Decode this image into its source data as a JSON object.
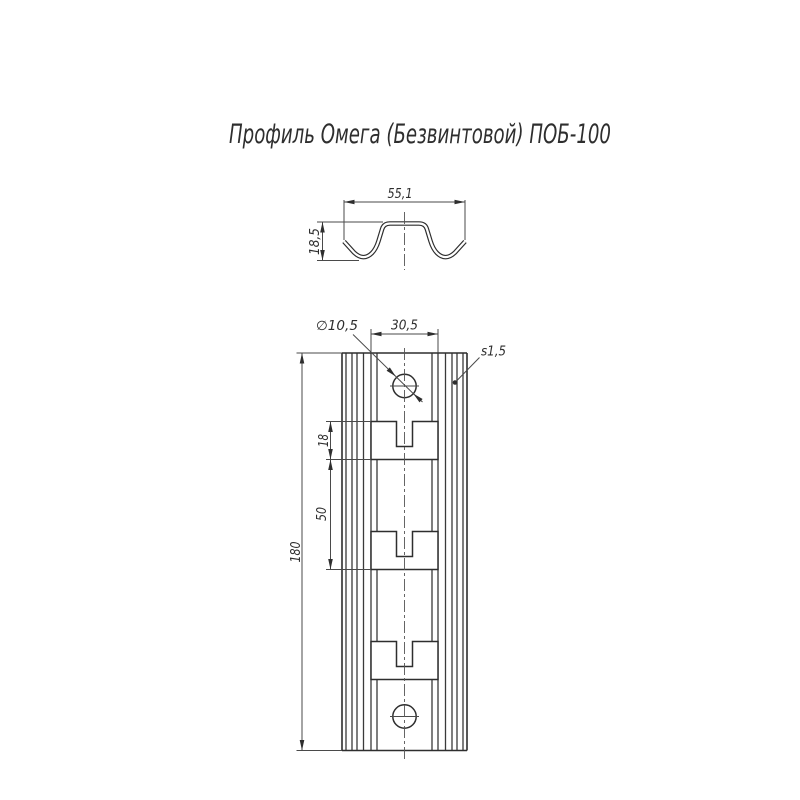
{
  "title": "Профиль Омега (Безвинтовой) ПОБ-100",
  "section_view": {
    "width": "55,1",
    "height": "18,5"
  },
  "front_view": {
    "hole_diameter": "∅10,5",
    "flange_width": "30,5",
    "thickness": "s1,5",
    "slot_height": "18",
    "slot_pitch": "50",
    "length": "180"
  },
  "colors": {
    "line": "#2e2e2e",
    "dim_line": "#4a4a4a",
    "background": "#ffffff"
  }
}
